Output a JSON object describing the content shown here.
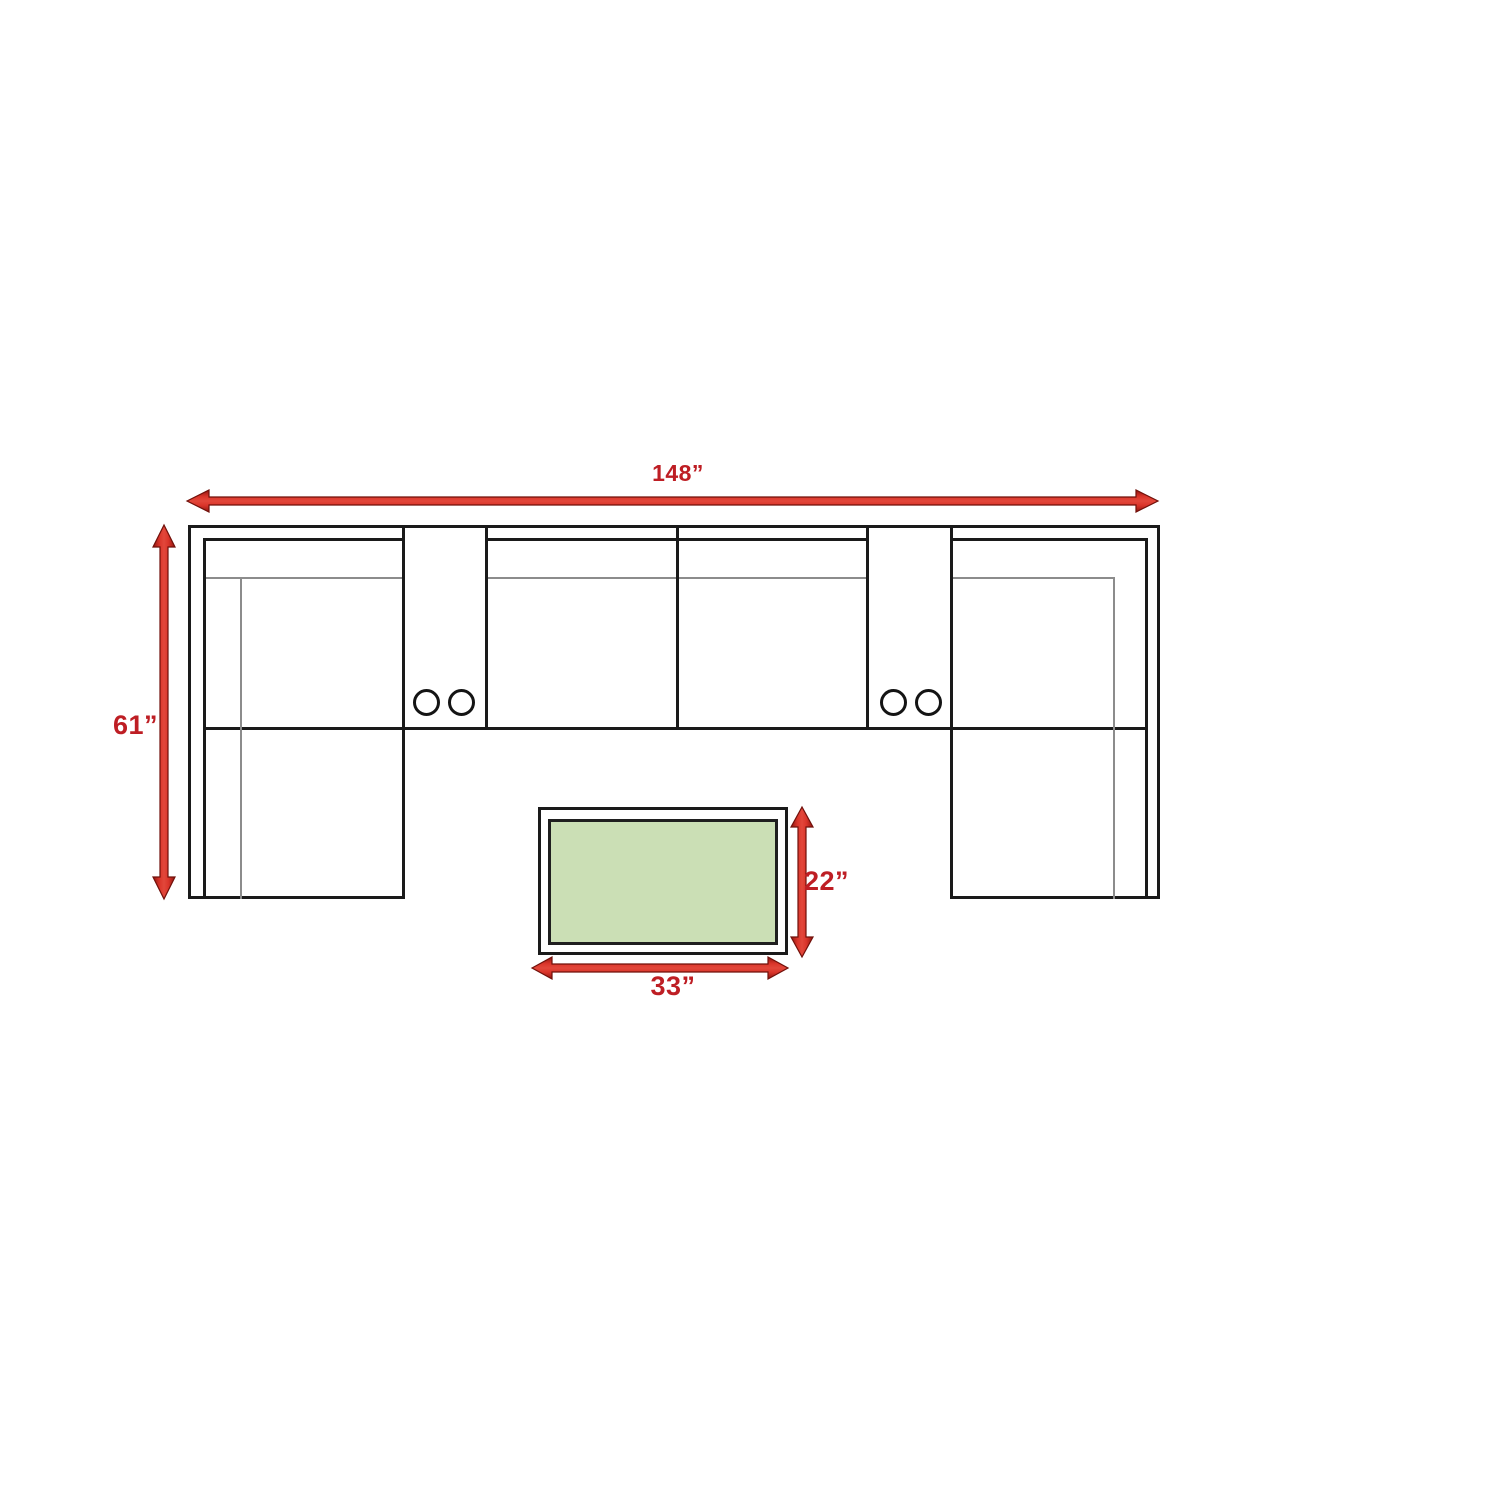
{
  "diagram": {
    "type": "furniture-dimension-diagram",
    "description": "Top-view dimension diagram of a U-shaped sectional sofa with two cupholder consoles and a rectangular coffee table",
    "sofa": {
      "width_label": "148”",
      "depth_label": "61”",
      "sections": [
        "left-chaise",
        "console-with-cupholders",
        "armless-seat",
        "armless-seat",
        "console-with-cupholders",
        "right-chaise"
      ],
      "cupholder_count": 4
    },
    "coffee_table": {
      "length_label": "33”",
      "depth_label": "22”",
      "top_color": "#cbdfb5"
    },
    "colors": {
      "dimension_red": "#be1e24",
      "arrow_red_bright": "#da352a",
      "arrow_red_dark": "#8e1510",
      "outline_black": "#1a1a1a",
      "thin_line_gray": "#8c8c8c",
      "background": "#ffffff"
    }
  }
}
